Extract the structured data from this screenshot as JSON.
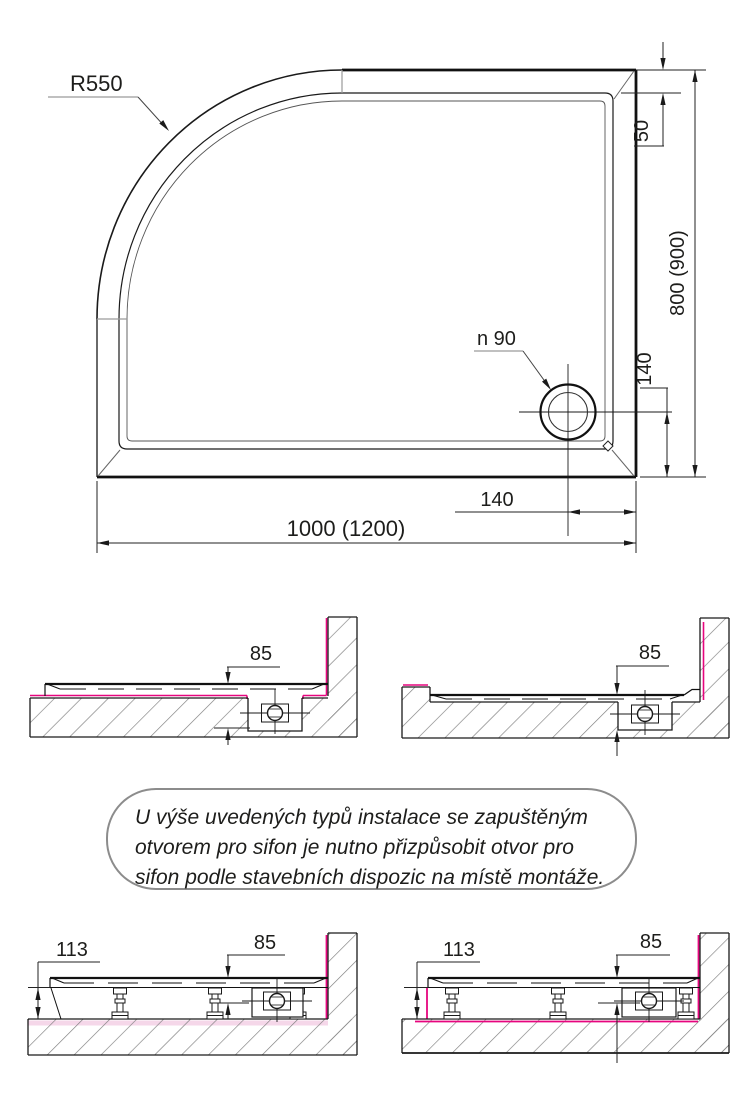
{
  "colors": {
    "magenta": "#e6057e",
    "pale_pink": "#f5d7e9",
    "hatch_gray": "#7e7e7e",
    "leader_gray": "#9a9a9a",
    "line_black": "#1a1a1a",
    "note_border_gray": "#8c8c8c"
  },
  "plan_view": {
    "corner_radius_label": "R550",
    "rim_width_label": "50",
    "depth_label": "800 (900)",
    "drain_label": "n 90",
    "drain_offset_vertical_label": "140",
    "drain_offset_horizontal_label": "140",
    "width_label": "1000 (1200)"
  },
  "sections_recessed": {
    "left": {
      "tray_height_label": "85"
    },
    "right": {
      "tray_height_label": "85"
    }
  },
  "note": {
    "line1": "U výše uvedených typů instalace se zapuštěným",
    "line2": "otvorem pro sifon je nutno přizpůsobit otvor pro",
    "line3": "sifon podle stavebních dispozic na místě montáže."
  },
  "sections_on_feet": {
    "left": {
      "feet_height_label": "113",
      "tray_height_label": "85"
    },
    "right": {
      "feet_height_label": "113",
      "tray_height_label": "85"
    }
  }
}
